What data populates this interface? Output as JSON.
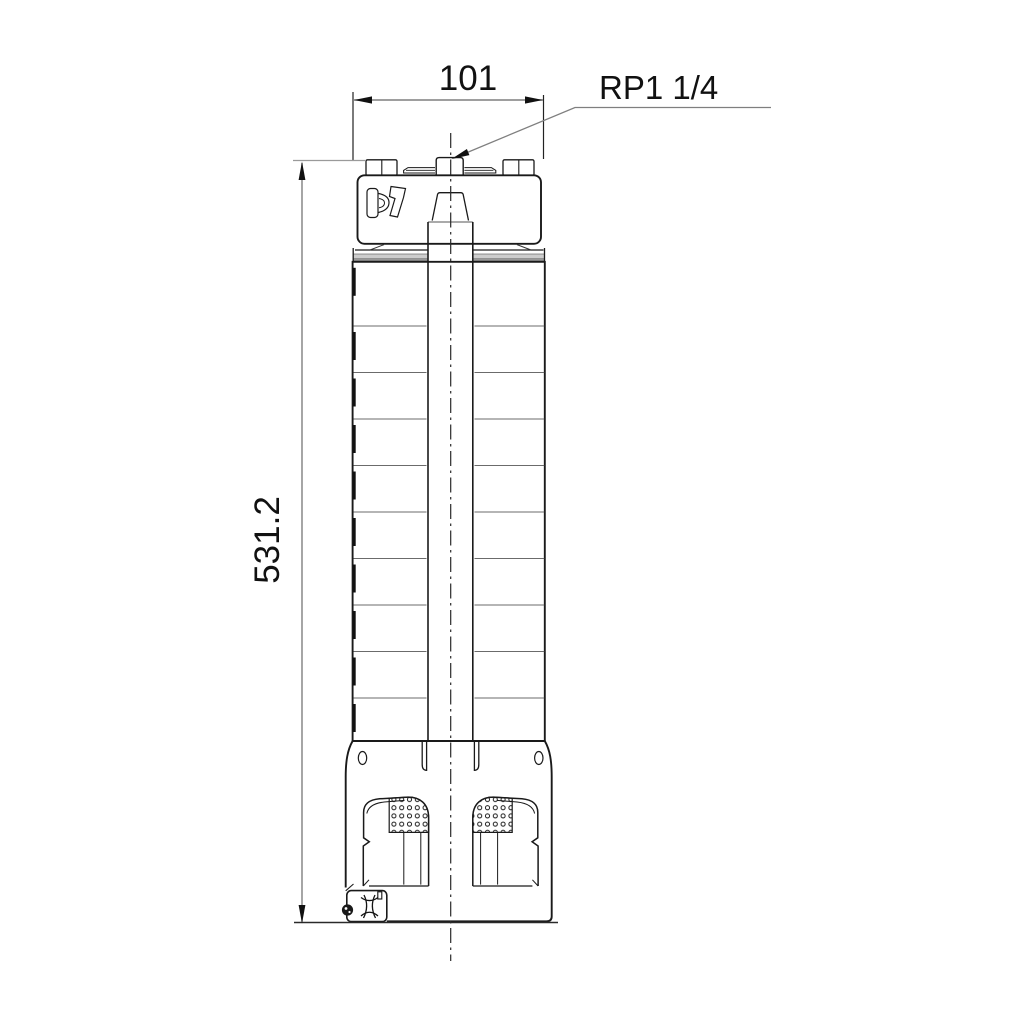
{
  "labels": {
    "width": "101",
    "height": "531.2",
    "connection": "RP1 1/4"
  },
  "colors": {
    "background": "#ffffff",
    "outline": "#1a1a1a",
    "dimension_lines": "#7f7f7f",
    "extension_lines": "#222222",
    "stage_lines": "#6b6b6b",
    "band_fill": "#cdcdcd",
    "text": "#111111"
  }
}
